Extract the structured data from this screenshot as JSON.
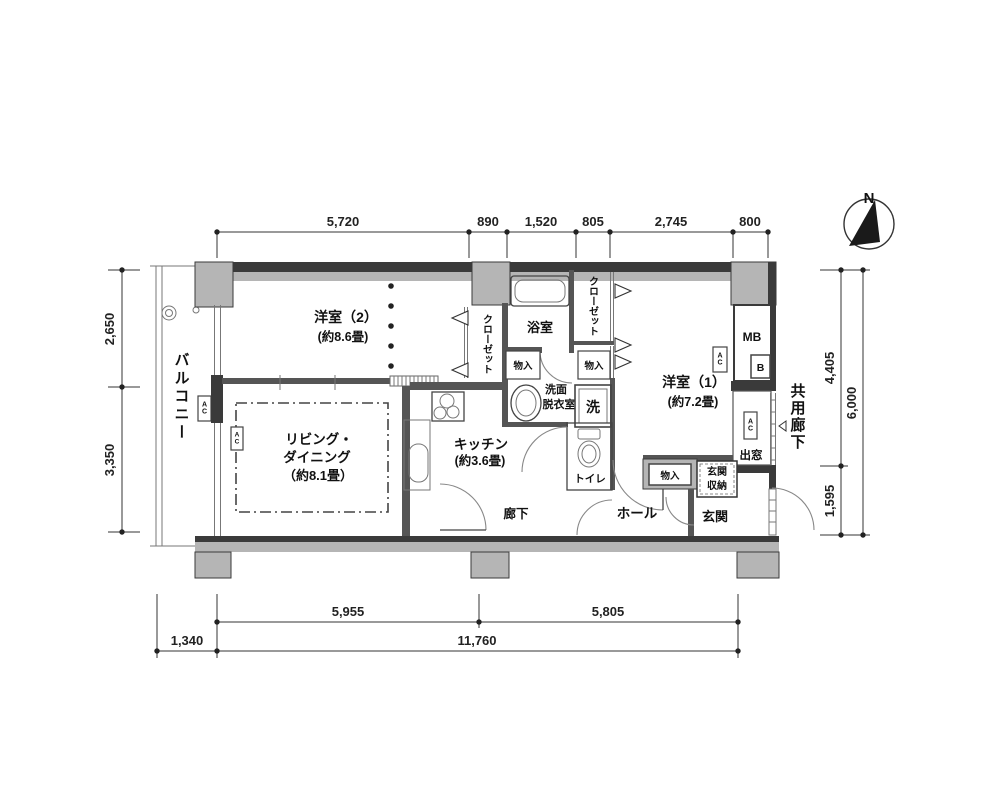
{
  "compass": {
    "north": "N"
  },
  "dims": {
    "top": [
      "5,720",
      "890",
      "1,520",
      "805",
      "2,745",
      "800"
    ],
    "left": [
      "2,650",
      "3,350"
    ],
    "right": [
      "4,405",
      "1,595",
      "6,000"
    ],
    "bottom": [
      "5,955",
      "5,805",
      "1,340",
      "11,760"
    ]
  },
  "rooms": {
    "balcony": "バルコニー",
    "room2": "洋室（2）",
    "room2_size": "(約8.6畳)",
    "room1": "洋室（1）",
    "room1_size": "(約7.2畳)",
    "living1": "リビング・",
    "living2": "ダイニング",
    "living3": "（約8.1畳）",
    "kitchen": "キッチン",
    "kitchen_size": "(約3.6畳)",
    "bath": "浴室",
    "washroom1": "洗面",
    "washroom2": "脱衣室",
    "washer": "洗",
    "toilet": "トイレ",
    "closet_left": "クローゼット",
    "closet_right": "クローゼット",
    "corridor": "廊下",
    "hall": "ホール",
    "entrance": "玄関",
    "entrance_storage1": "玄関",
    "entrance_storage2": "収納",
    "storage_a": "物入",
    "storage_b": "物入",
    "storage_c": "物入",
    "bay_window": "出窓",
    "common_corridor": "共用廊下",
    "meter_box": "MB",
    "b_box": "B",
    "ac": "AC"
  },
  "colors": {
    "wall": "#3a3a3a",
    "pillar": "#b5b5b5",
    "line": "#444444"
  }
}
